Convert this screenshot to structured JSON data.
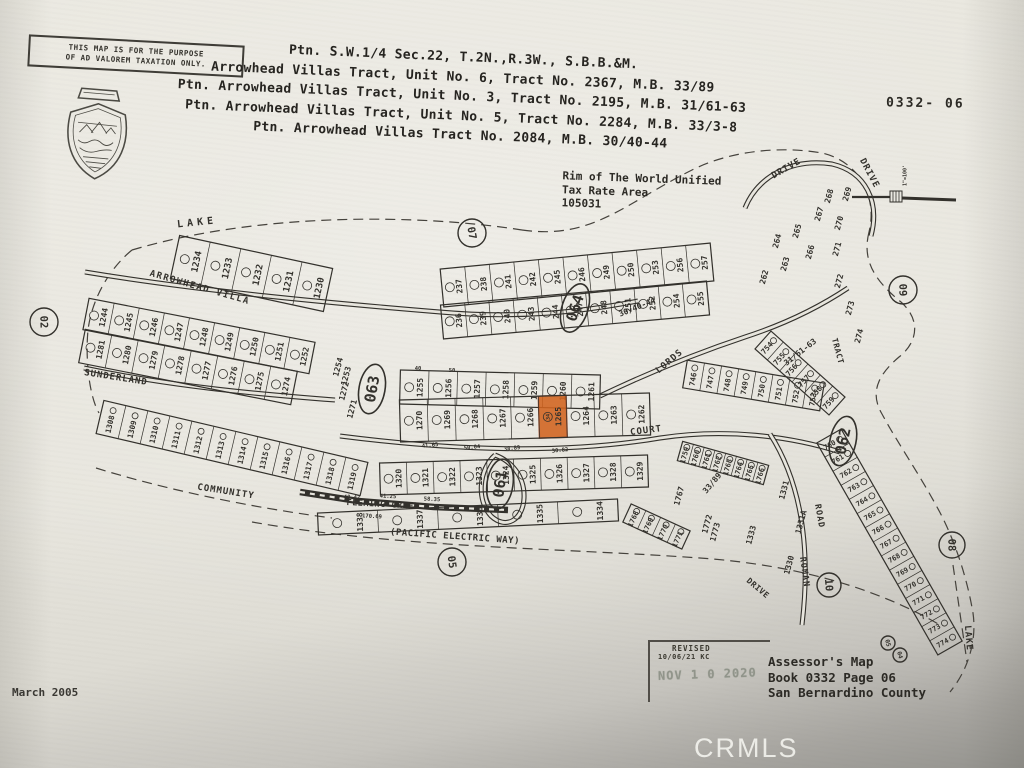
{
  "header": {
    "disclaimer_line1": "THIS MAP IS FOR THE PURPOSE",
    "disclaimer_line2": "OF AD VALOREM TAXATION ONLY.",
    "titles": [
      "Ptn. S.W.1/4 Sec.22, T.2N.,R.3W., S.B.B.&M.",
      "Arrowhead Villas Tract, Unit No. 6, Tract No. 2367, M.B. 33/89",
      "Ptn. Arrowhead Villas Tract, Unit No. 3, Tract No. 2195, M.B. 31/61-63",
      "Ptn. Arrowhead Villas Tract, Unit No. 5, Tract No. 2284, M.B. 33/3-8",
      "Ptn. Arrowhead Villas Tract No. 2084, M.B. 30/40-44"
    ],
    "sheet_code": "0332- 06",
    "scale_label": "1\"=100'"
  },
  "tax_area": {
    "line1": "Rim of The World Unified",
    "line2": "Tax Rate Area",
    "line3": "105031"
  },
  "footer": {
    "revised_label": "REVISED",
    "revised_date": "10/06/21 KC",
    "stamp_text": "NOV 1 0 2020",
    "assessor_lines": [
      "Assessor's Map",
      "Book 0332 Page 06",
      "San Bernardino County"
    ],
    "map_date": "March 2005",
    "watermark": "CRMLS"
  },
  "map": {
    "ink": "#33312c",
    "paper": "#e7e5dd",
    "highlight_color": "#d2641f",
    "highlight_edge": "#a33c12",
    "highlighted_parcel": {
      "number": "1265",
      "lot": "34"
    },
    "strips": [
      {
        "parcels": [
          "1234",
          "1233",
          "1232",
          "1231",
          "1230"
        ],
        "x1": 175,
        "y1": 257,
        "x2": 328,
        "y2": 290,
        "w": 44,
        "fs": 9
      },
      {
        "parcels": [
          "237",
          "238",
          "241",
          "242",
          "245",
          "246",
          "249",
          "250",
          "253",
          "256",
          "257"
        ],
        "x1": 442,
        "y1": 288,
        "x2": 712,
        "y2": 262,
        "w": 38,
        "fs": 8
      },
      {
        "parcels": [
          "236",
          "239",
          "240",
          "243",
          "244",
          "247",
          "248",
          "251",
          "252",
          "254",
          "255"
        ],
        "x1": 442,
        "y1": 322,
        "x2": 708,
        "y2": 298,
        "w": 34,
        "fs": 8
      },
      {
        "parcels": [
          "1255",
          "1256",
          "1257",
          "1258",
          "1259",
          "1260",
          "1261"
        ],
        "x1": 400,
        "y1": 387,
        "x2": 600,
        "y2": 392,
        "w": 34,
        "fs": 8
      },
      {
        "parcels": [
          "1270",
          "1269",
          "1268",
          "1267",
          "1266",
          "1265",
          "1264",
          "1263",
          "1262"
        ],
        "x1": 400,
        "y1": 421,
        "x2": 650,
        "y2": 414,
        "w": 42,
        "fs": 8
      },
      {
        "parcels": [
          "1244",
          "1245",
          "1246",
          "1247",
          "1248",
          "1249",
          "1250",
          "1251",
          "1252"
        ],
        "x1": 86,
        "y1": 314,
        "x2": 312,
        "y2": 358,
        "w": 32,
        "fs": 8
      },
      {
        "parcels": [
          "1281",
          "1280",
          "1279",
          "1278",
          "1277",
          "1276",
          "1275",
          "1274"
        ],
        "x1": 82,
        "y1": 346,
        "x2": 294,
        "y2": 388,
        "w": 34,
        "fs": 8
      },
      {
        "parcels": [
          "1308",
          "1309",
          "1310",
          "1311",
          "1312",
          "1313",
          "1314",
          "1315",
          "1316",
          "1317",
          "1318",
          "1319"
        ],
        "x1": 100,
        "y1": 417,
        "x2": 364,
        "y2": 479,
        "w": 34,
        "fs": 7.5
      },
      {
        "parcels": [
          "1320",
          "1321",
          "1322",
          "1323",
          "1324",
          "1325",
          "1326",
          "1327",
          "1328",
          "1329"
        ],
        "x1": 380,
        "y1": 479,
        "x2": 648,
        "y2": 471,
        "w": 32,
        "fs": 8
      },
      {
        "parcels": [
          "1338",
          "1337",
          "1336",
          "1335",
          "1334"
        ],
        "x1": 318,
        "y1": 524,
        "x2": 618,
        "y2": 510,
        "w": 22,
        "fs": 8
      },
      {
        "parcels": [
          "746",
          "747",
          "748",
          "749",
          "750",
          "751",
          "752",
          "753"
        ],
        "x1": 685,
        "y1": 374,
        "x2": 822,
        "y2": 397,
        "w": 28,
        "fs": 7.5
      },
      {
        "parcels": [
          "754",
          "755",
          "756",
          "757",
          "758",
          "759"
        ],
        "x1": 763,
        "y1": 340,
        "x2": 837,
        "y2": 406,
        "w": 24,
        "fs": 7.5
      },
      {
        "parcels": [
          "760",
          "761",
          "762",
          "763",
          "764",
          "765",
          "766",
          "767",
          "768",
          "769",
          "770",
          "771",
          "772",
          "773",
          "774"
        ],
        "x1": 829,
        "y1": 436,
        "x2": 950,
        "y2": 648,
        "w": 28,
        "fs": 7
      },
      {
        "parcels": [
          "1759",
          "1760",
          "1761",
          "1762",
          "1763",
          "1764",
          "1765",
          "1766"
        ],
        "x1": 680,
        "y1": 451,
        "x2": 766,
        "y2": 475,
        "w": 20,
        "fs": 7
      },
      {
        "parcels": [
          "1768",
          "1769",
          "1770",
          "1771"
        ],
        "x1": 627,
        "y1": 513,
        "x2": 686,
        "y2": 540,
        "w": 20,
        "fs": 7
      }
    ],
    "page_circles": [
      {
        "n": "02",
        "x": 44,
        "y": 322,
        "r": 14,
        "rot": 88
      },
      {
        "n": "07",
        "x": 472,
        "y": 233,
        "r": 14,
        "rot": 80
      },
      {
        "n": "09",
        "x": 903,
        "y": 290,
        "r": 14,
        "rot": 88
      },
      {
        "n": "05",
        "x": 452,
        "y": 562,
        "r": 14,
        "rot": 82
      },
      {
        "n": "08",
        "x": 952,
        "y": 545,
        "r": 13,
        "rot": 88
      },
      {
        "n": "10",
        "x": 829,
        "y": 585,
        "r": 12,
        "rot": 85
      },
      {
        "n": "05",
        "x": 888,
        "y": 643,
        "r": 7,
        "rot": 75,
        "fs": 6
      },
      {
        "n": "04",
        "x": 900,
        "y": 655,
        "r": 7,
        "rot": 75,
        "fs": 6
      }
    ],
    "block_ovals": [
      {
        "n": "063",
        "x": 372,
        "y": 389,
        "rot": -80
      },
      {
        "n": "064",
        "x": 575,
        "y": 308,
        "rot": -72
      },
      {
        "n": "061",
        "x": 500,
        "y": 484,
        "rot": -82
      },
      {
        "n": "062",
        "x": 843,
        "y": 441,
        "rot": -78
      }
    ],
    "streets": [
      {
        "t": "LAKE",
        "x": 197,
        "y": 222,
        "r": -6,
        "ls": 4,
        "s": 10
      },
      {
        "t": "ARROWHEAD VILLA",
        "x": 200,
        "y": 287,
        "r": 16,
        "ls": 1.5,
        "s": 9
      },
      {
        "t": "SUNDERLAND",
        "x": 116,
        "y": 377,
        "r": 9,
        "ls": 1,
        "s": 9
      },
      {
        "t": "COMMUNITY",
        "x": 226,
        "y": 491,
        "r": 9,
        "ls": 1,
        "s": 9
      },
      {
        "t": "FLEMING CREEK",
        "x": 383,
        "y": 504,
        "r": 3,
        "ls": 0.5,
        "s": 8.5
      },
      {
        "t": "(PACIFIC ELECTRIC WAY)",
        "x": 455,
        "y": 536,
        "r": 4,
        "ls": 0.5,
        "s": 9
      },
      {
        "t": "COURT",
        "x": 646,
        "y": 430,
        "r": -7,
        "ls": 1,
        "s": 9
      },
      {
        "t": "LORDS",
        "x": 669,
        "y": 361,
        "r": -40,
        "ls": 1,
        "s": 9
      },
      {
        "t": "DRIVE",
        "x": 786,
        "y": 168,
        "r": -30,
        "ls": 1,
        "s": 9
      },
      {
        "t": "DRIVE",
        "x": 870,
        "y": 173,
        "r": 62,
        "ls": 1,
        "s": 9
      },
      {
        "t": "ROAD",
        "x": 820,
        "y": 516,
        "r": 80,
        "ls": 1,
        "s": 8.5
      },
      {
        "t": "ROMAN",
        "x": 805,
        "y": 572,
        "r": 82,
        "ls": 1,
        "s": 8.5
      },
      {
        "t": "TRACT",
        "x": 838,
        "y": 351,
        "r": 75,
        "ls": 0.5,
        "s": 8
      },
      {
        "t": "LAKE",
        "x": 969,
        "y": 638,
        "r": 85,
        "ls": 1,
        "s": 9
      },
      {
        "t": "DRIVE",
        "x": 758,
        "y": 588,
        "r": 40,
        "ls": 0.5,
        "s": 8
      }
    ],
    "labels": [
      {
        "t": "1272",
        "x": 344,
        "y": 391
      },
      {
        "t": "1271",
        "x": 352,
        "y": 409
      },
      {
        "t": "1254",
        "x": 338,
        "y": 367
      },
      {
        "t": "1253",
        "x": 346,
        "y": 376
      },
      {
        "t": "262",
        "x": 764,
        "y": 277
      },
      {
        "t": "263",
        "x": 785,
        "y": 264
      },
      {
        "t": "264",
        "x": 777,
        "y": 241
      },
      {
        "t": "265",
        "x": 797,
        "y": 231
      },
      {
        "t": "266",
        "x": 810,
        "y": 252
      },
      {
        "t": "267",
        "x": 819,
        "y": 214
      },
      {
        "t": "268",
        "x": 829,
        "y": 196
      },
      {
        "t": "269",
        "x": 847,
        "y": 194
      },
      {
        "t": "270",
        "x": 839,
        "y": 223
      },
      {
        "t": "271",
        "x": 837,
        "y": 249
      },
      {
        "t": "272",
        "x": 839,
        "y": 281
      },
      {
        "t": "273",
        "x": 850,
        "y": 308
      },
      {
        "t": "274",
        "x": 859,
        "y": 336
      },
      {
        "t": "1331",
        "x": 784,
        "y": 490
      },
      {
        "t": "1331A",
        "x": 801,
        "y": 522
      },
      {
        "t": "1330",
        "x": 789,
        "y": 565
      },
      {
        "t": "1333",
        "x": 751,
        "y": 535
      },
      {
        "t": "1767",
        "x": 679,
        "y": 496
      },
      {
        "t": "1772",
        "x": 707,
        "y": 524
      },
      {
        "t": "1773",
        "x": 715,
        "y": 532
      },
      {
        "t": "33/89",
        "x": 712,
        "y": 483,
        "r": -50,
        "s": 8
      },
      {
        "t": "31/61-63",
        "x": 800,
        "y": 352,
        "r": -38,
        "s": 8
      },
      {
        "t": "30/40-44",
        "x": 637,
        "y": 307,
        "r": -22,
        "s": 8
      },
      {
        "t": "50.04",
        "x": 472,
        "y": 447,
        "r": -6,
        "s": 5.5
      },
      {
        "t": "38.89",
        "x": 512,
        "y": 448,
        "r": -6,
        "s": 5.5
      },
      {
        "t": "30.82",
        "x": 560,
        "y": 450,
        "r": -6,
        "s": 5.5
      },
      {
        "t": "41.65",
        "x": 430,
        "y": 445,
        "r": -6,
        "s": 5.5
      },
      {
        "t": "170.69",
        "x": 372,
        "y": 516,
        "r": 3,
        "s": 5.5
      },
      {
        "t": "40.47",
        "x": 352,
        "y": 497,
        "r": 3,
        "s": 5.5
      },
      {
        "t": "41.25",
        "x": 388,
        "y": 496,
        "r": 3,
        "s": 5.5
      },
      {
        "t": "58.35",
        "x": 432,
        "y": 499,
        "r": 3,
        "s": 5.5
      },
      {
        "t": "40",
        "x": 418,
        "y": 368,
        "r": 0,
        "s": 5.5
      },
      {
        "t": "50",
        "x": 452,
        "y": 370,
        "r": 0,
        "s": 5.5
      }
    ]
  }
}
